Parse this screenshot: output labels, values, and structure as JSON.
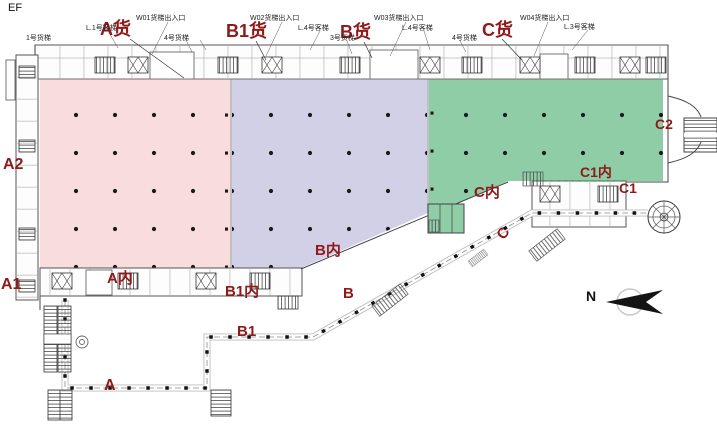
{
  "page": {
    "corner_mark": "EF"
  },
  "colors": {
    "zone_a_pink": "#f9dcdc",
    "zone_b1_lavender": "#d2d0e6",
    "zone_c_green": "#8ecda6",
    "label_red": "#8e1a1a",
    "wall_line": "#444444",
    "column_dot": "#1a1a1a"
  },
  "zones": [
    {
      "id": "A",
      "fill": "#f9dcdc"
    },
    {
      "id": "B1",
      "fill": "#d2d0e6"
    },
    {
      "id": "C",
      "fill": "#8ecda6"
    }
  ],
  "compass": {
    "north_label": "N"
  },
  "labels": {
    "ef": "EF",
    "a_freight": "A货",
    "b1_freight": "B1货",
    "b_freight": "B货",
    "c_freight": "C货",
    "a2": "A2",
    "a1": "A1",
    "a_inner": "A内",
    "b1_inner": "B1内",
    "b_inner": "B内",
    "b_walk": "B",
    "b1_walk": "B1",
    "a_walk": "A",
    "c_inner": "C内",
    "c_walk": "C",
    "c1_inner": "C1内",
    "c1": "C1",
    "c2": "C2",
    "north": "N",
    "ann_lift1": "L.1号客梯",
    "ann_w01": "W01货梯出入口",
    "ann_cargo1": "1号货梯",
    "ann_cargo4a": "4号货梯",
    "ann_w02": "W02货梯出入口",
    "ann_lift4a": "L.4号客梯",
    "ann_cargo3": "3号货梯",
    "ann_w03": "W03货梯出入口",
    "ann_lift4b": "L.4号客梯",
    "ann_cargo4b": "4号货梯",
    "ann_w04": "W04货梯出入口",
    "ann_lift3": "L.3号客梯"
  }
}
